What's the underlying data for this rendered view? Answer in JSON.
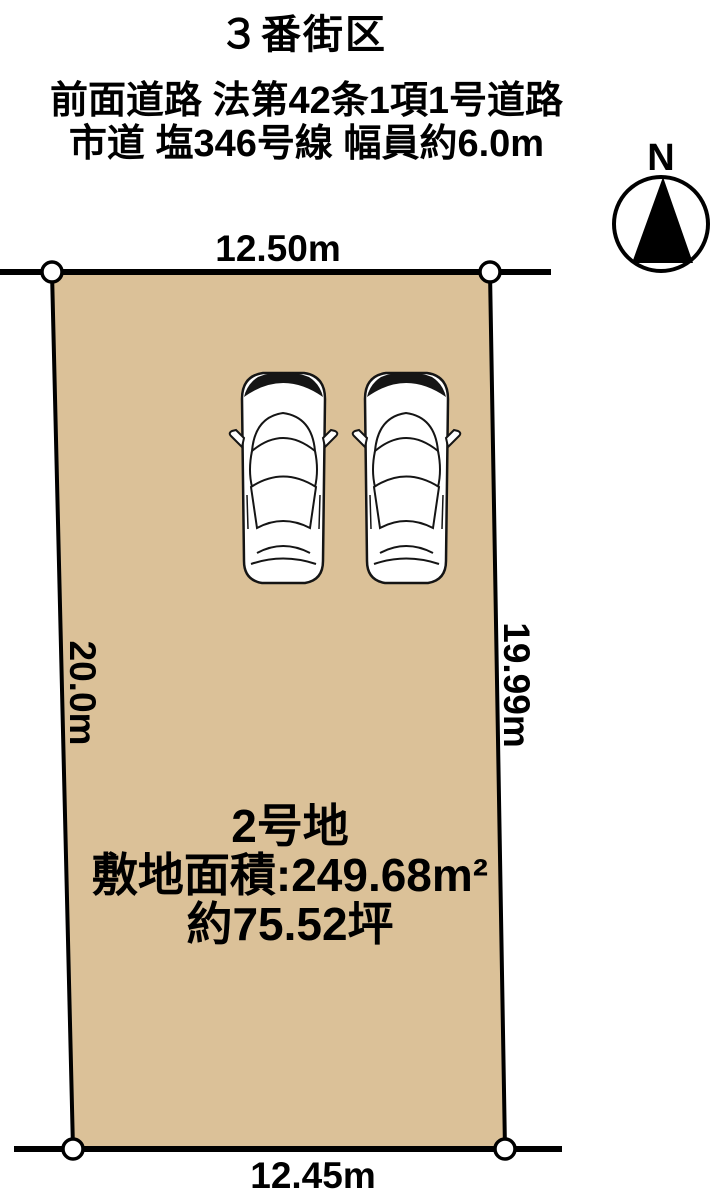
{
  "header": {
    "block_title": "３番街区",
    "road_info": [
      "前面道路 法第42条1項1号道路",
      "市道 塩346号線 幅員約6.0m"
    ]
  },
  "compass": {
    "label": "N"
  },
  "lot": {
    "name": "2号地",
    "site_area": "敷地面積:249.68m²",
    "area_tsubo": "約75.52坪",
    "fill_color": "#dbc198",
    "line_color": "#000000",
    "dimensions": {
      "top": "12.50m",
      "bottom": "12.45m",
      "left": "20.0m",
      "right": "19.99m"
    }
  },
  "cars": {
    "count": 2,
    "icon": "car-top-view"
  }
}
